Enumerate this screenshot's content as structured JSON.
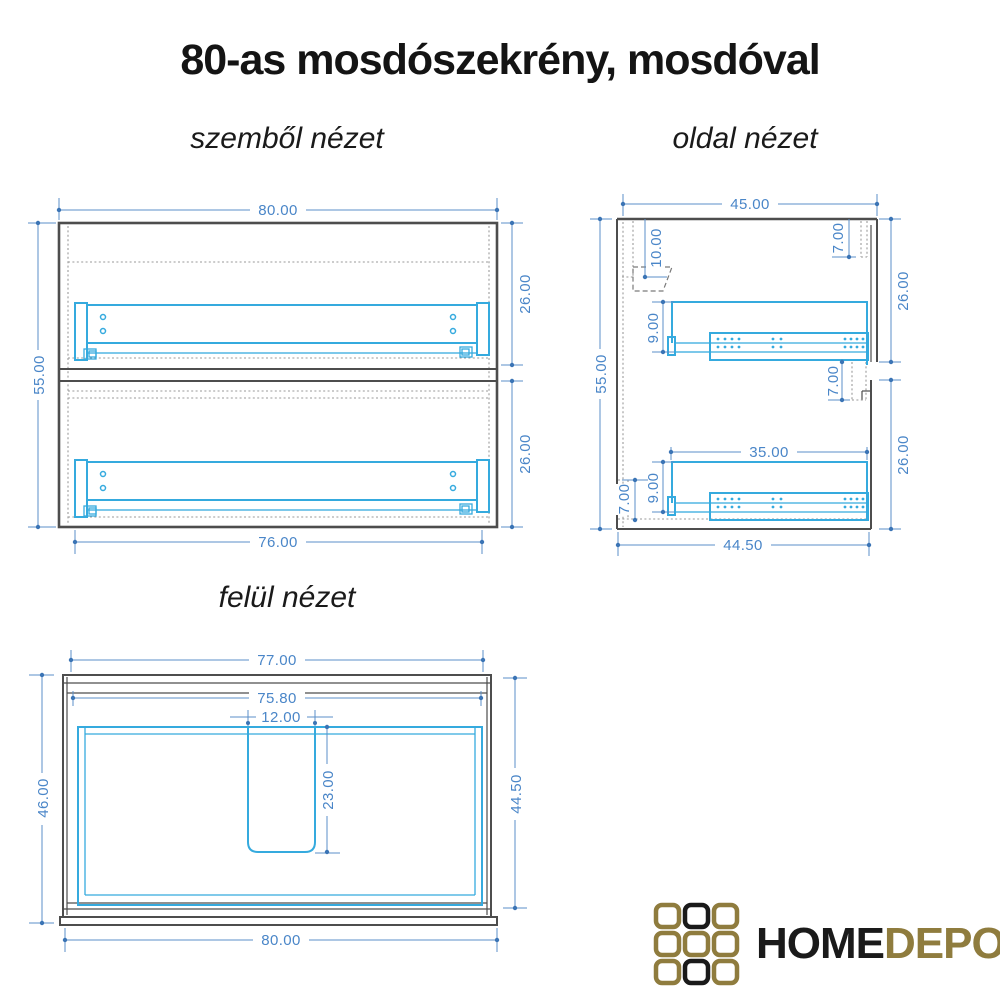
{
  "title": "80-as mosdószekrény, mosdóval",
  "views": {
    "front": {
      "label": "szemből nézet",
      "dims": {
        "width_top": "80.00",
        "height": "55.00",
        "upper_drawer": "26.00",
        "lower_drawer": "26.00",
        "width_bottom": "76.00"
      }
    },
    "side": {
      "label": "oldal nézet",
      "dims": {
        "depth_top": "45.00",
        "height": "55.00",
        "back_rail": "10.00",
        "top_front": "7.00",
        "upper_section": "26.00",
        "upper_rail_offset": "9.00",
        "mid_front": "7.00",
        "drawer_depth": "35.00",
        "lower_rail_offset": "9.00",
        "plinth": "7.00",
        "lower_section": "26.00",
        "depth_bottom": "44.50"
      }
    },
    "top": {
      "label": "felül nézet",
      "dims": {
        "width_top": "77.00",
        "width_inner": "75.80",
        "cutout_width": "12.00",
        "cutout_depth": "23.00",
        "depth_left": "46.00",
        "depth_right": "44.50",
        "width_bottom": "80.00"
      }
    }
  },
  "logo": {
    "home": "HOME",
    "depo": "DEPO"
  },
  "colors": {
    "dimension_text": "#4a86c8",
    "dimension_line": "#5b8fc9",
    "drawer_cyan": "#35aade",
    "outline_gray": "#4d4d4d",
    "hidden_line_gray": "#9a9a9a",
    "logo_gold": "#8f7c3e",
    "logo_black": "#1a1a1a"
  }
}
